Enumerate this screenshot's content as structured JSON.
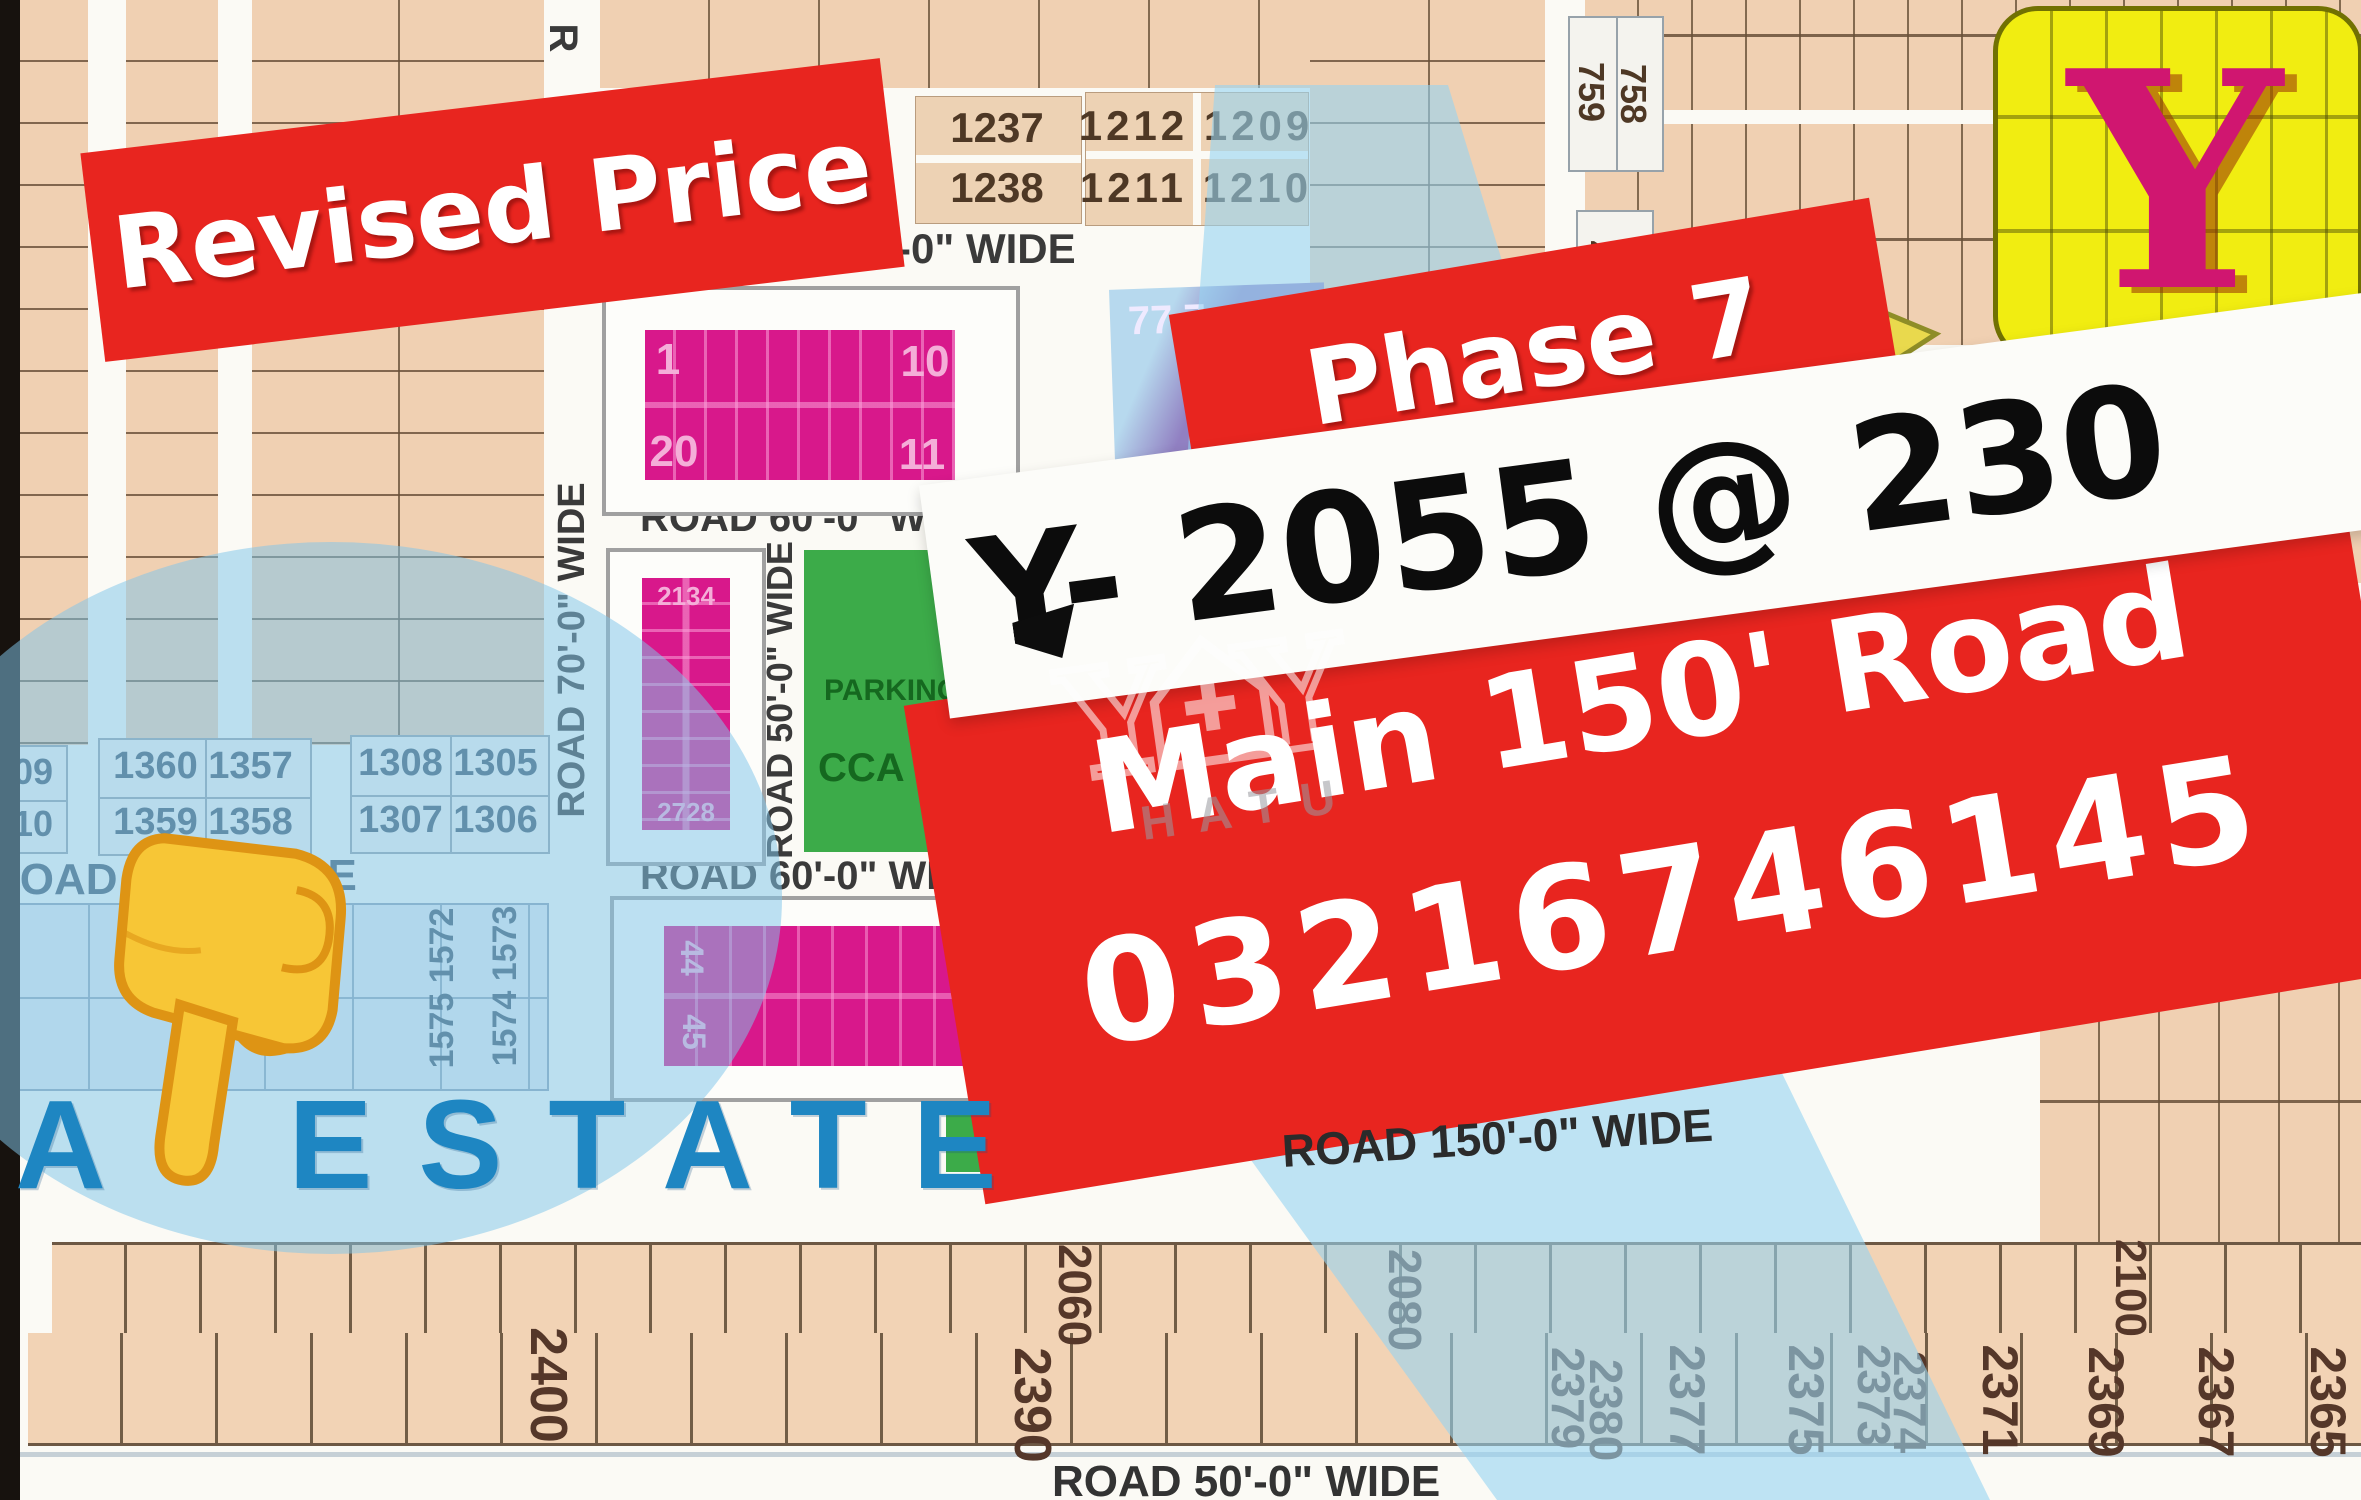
{
  "colors": {
    "banner_red": "#E8251F",
    "magenta": "#D8188B",
    "green": "#3CAB49",
    "yellow_block": "#F1ED11",
    "blue_overlay": "#A8D8F0",
    "estate_blue": "#1E86C2",
    "tan_plot": "#F0D0B2",
    "y_letter": "#D01670"
  },
  "banners": {
    "revised_price": "Revised Price",
    "phase": "Phase 7",
    "listing": "Y- 2055 @ 230",
    "road_line": "Main 150' Road",
    "phone": "03216746145"
  },
  "watermark": {
    "label": "HATU"
  },
  "estate_label": "A ESTATE",
  "roads": {
    "r_top": "R",
    "v70": "ROAD 70'-0\" WIDE",
    "top70": "ROAD 70'-0\" WIDE",
    "mid60_upper": "ROAD 60'-0\" WIDE",
    "mid60_lower": "ROAD 60'-0\" WIDE",
    "v50": "ROAD 50'-0\" WIDE",
    "left_road": "ROAD",
    "left_wide": "WIDE",
    "r150": "ROAD 150'-0\" WIDE",
    "bottom50": "ROAD 50'-0\" WIDE"
  },
  "blocks": {
    "block1": {
      "tl": "1",
      "tr": "10",
      "bl": "20",
      "br": "11"
    },
    "purple_block": "77 7",
    "block2": {
      "top": "2134",
      "bottom": "2728"
    },
    "green_block": {
      "line1": "PARKING",
      "line2": "CCA -"
    },
    "block3": {
      "left_top": "44",
      "left_bottom": "45",
      "right": "54 3"
    },
    "y_logo": "Y"
  },
  "plot_numbers": {
    "top": {
      "a1": "1237",
      "a2": "1238",
      "b1": "1212 1209",
      "b2": "1211 1210"
    },
    "right": {
      "r1": "759",
      "r2": "758",
      "r3": "4",
      "r4": "5"
    },
    "left": {
      "e1": "09",
      "e2": "10",
      "p1": "1360 1357",
      "p2": "1359 1358",
      "q1": "1308 1305",
      "q2": "1307 1306",
      "v1": "1575 1572",
      "v2": "1574 1573"
    },
    "bottom": {
      "n2400": "2400",
      "n2060": "2060",
      "n2390": "2390",
      "n2080": "2080",
      "n2379": "2379",
      "n2380": "2380",
      "n2377": "2377",
      "n2375": "2375",
      "n2373": "2373",
      "n2374": "2374",
      "n2371": "2371",
      "n2369": "2369",
      "n2367": "2367",
      "n2365": "2365",
      "n2100": "2100"
    }
  }
}
